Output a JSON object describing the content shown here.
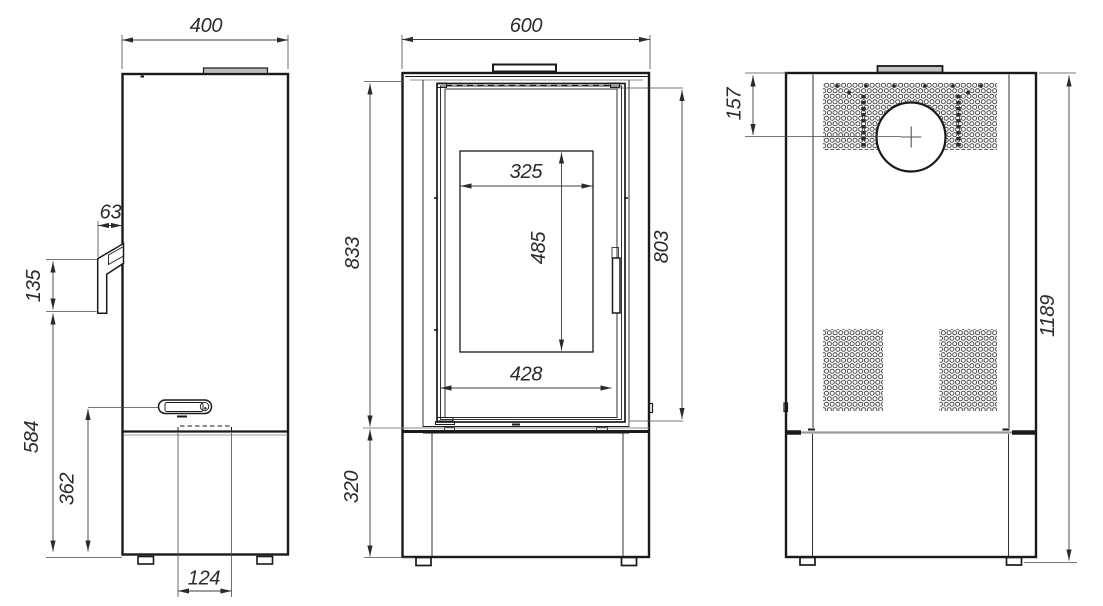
{
  "drawing": {
    "title": "Stove dimension drawing, three orthographic views",
    "units": "mm"
  },
  "views": {
    "side": {
      "name": "Side view",
      "dims": {
        "width": "400",
        "handle_depth": "63",
        "handle_height": "135",
        "lower_height": "584",
        "ash_handle_height": "362",
        "drawer_width": "124"
      }
    },
    "front": {
      "name": "Front view",
      "dims": {
        "width": "600",
        "upper_height": "833",
        "base_height": "320",
        "glass_width": "325",
        "glass_height": "485",
        "door_width": "428",
        "door_height": "803"
      }
    },
    "back": {
      "name": "Back view",
      "dims": {
        "flue_center_offset": "157",
        "total_height": "1189"
      }
    }
  },
  "colors": {
    "line": "#1a1a1a",
    "dim_line": "#3d3d3d",
    "text": "#2b2b2b",
    "background": "#ffffff",
    "plate_fill": "#bdbdbd",
    "separator_gray": "#9a9a9a"
  }
}
